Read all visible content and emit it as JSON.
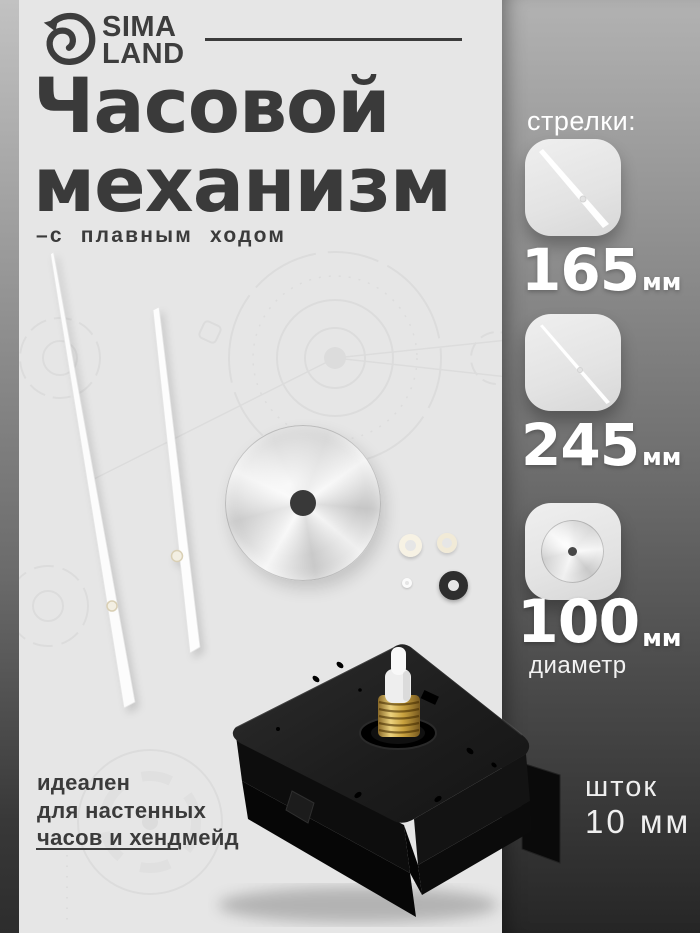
{
  "brand": {
    "line1": "SIMA",
    "line2": "LAND"
  },
  "header": {
    "title_line1": "Часовой",
    "title_line2": "механизм",
    "subtitle": "–с плавным ходом"
  },
  "specs": {
    "section_label": "стрелки:",
    "items": [
      {
        "icon": "clock-hand-icon",
        "value": "165",
        "unit": "мм"
      },
      {
        "icon": "clock-hand-icon",
        "value": "245",
        "unit": "мм"
      },
      {
        "icon": "dial-disc-icon",
        "value": "100",
        "unit": "мм",
        "note": "диаметр"
      }
    ],
    "stem": {
      "label": "шток",
      "value": "10 мм"
    }
  },
  "footer": {
    "line1": "идеален",
    "line2": "для настенных",
    "line3": "часов и хендмейд"
  },
  "colors": {
    "background": "#e6e6e6",
    "ink": "#3a3a3a",
    "panel_top": "#b2b2b2",
    "panel_bottom": "#262626",
    "badge": "#e9e9e9",
    "value_text": "#ffffff"
  }
}
